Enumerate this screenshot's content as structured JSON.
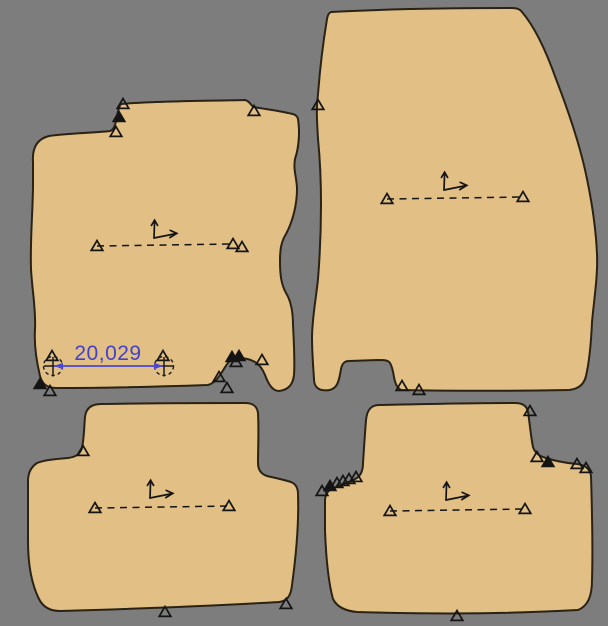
{
  "app": {
    "name": "cad-pattern-canvas",
    "background_color": "#7d7d7d",
    "canvas_width": 608,
    "canvas_height": 626
  },
  "style": {
    "mat_fill": "#e1bf85",
    "outline_color": "#2a2214",
    "marker_color": "#141414",
    "annotation_color": "#1c1c1c",
    "accent_blue": "#4b48d4",
    "dim_text_color": "#4340cc"
  },
  "dimension": {
    "label": "20,029",
    "value": 20029,
    "p1": {
      "x": 53,
      "y": 366
    },
    "p2": {
      "x": 164,
      "y": 366
    },
    "label_pos": {
      "x": 108,
      "y": 360
    },
    "font_size": 21,
    "circle_radius": 9.5
  },
  "mats": [
    {
      "name": "front-mat-left",
      "path": "M 33 162 C 32 148 37 139 49 136 C 70 133 94 133 110 131 C 114 130 116 123 117 116 C 118 111 119 106 121 104 C 155 101 205 101 245 100 C 250 101 250 105 254 107 C 263 109 276 110 288 113 C 294 114 297 115 298 119 C 300 132 299 147 295 159 C 293 170 297 179 297 189 C 297 204 293 221 286 234 C 281 242 280 250 280 261 C 280 274 281 284 286 293 C 291 301 293 312 293 325 C 294 344 295 361 294 375 C 293 385 288 390 279 391 C 272 391 268 383 265 375 C 263 370 260 365 255 362 C 250 359 245 358 239 358 L 235 358 C 229 359 226 366 222 372 C 218 378 215 383 208 385 C 150 387 95 388 57 388 C 47 388 42 384 40 376 C 36 359 34 344 35 329 C 36 309 32 289 31 269 C 30 239 33 209 33 184 Z",
      "axis": {
        "x": 154,
        "y": 238
      },
      "baseline": {
        "x1": 97,
        "y1": 246,
        "x2": 233,
        "y2": 244
      },
      "markers": [
        {
          "x": 123,
          "y": 104,
          "filled": false
        },
        {
          "x": 119,
          "y": 117,
          "filled": true
        },
        {
          "x": 116,
          "y": 132,
          "filled": false
        },
        {
          "x": 254,
          "y": 111,
          "filled": false
        },
        {
          "x": 242,
          "y": 247,
          "filled": false
        },
        {
          "x": 52,
          "y": 356,
          "filled": false
        },
        {
          "x": 163,
          "y": 356,
          "filled": false
        },
        {
          "x": 40,
          "y": 384,
          "filled": true
        },
        {
          "x": 50,
          "y": 391,
          "filled": false
        },
        {
          "x": 232,
          "y": 357,
          "filled": true
        },
        {
          "x": 239,
          "y": 356,
          "filled": true
        },
        {
          "x": 236,
          "y": 362,
          "filled": false
        },
        {
          "x": 262,
          "y": 360,
          "filled": false
        },
        {
          "x": 219,
          "y": 377,
          "filled": false
        },
        {
          "x": 227,
          "y": 388,
          "filled": false
        }
      ]
    },
    {
      "name": "front-mat-right",
      "path": "M 331 12 C 385 9 455 8 512 8 C 517 8 520 9 522 12 C 534 26 545 48 556 79 C 568 110 580 144 587 179 C 592 203 596 231 597 254 C 598 275 594 300 592 322 C 591 345 589 363 586 376 C 584 385 578 389 569 390 C 512 391 452 391 401 390 C 397 388 395 383 394 377 C 393 371 392 366 390 363 C 388 360 384 360 378 360 L 349 361 C 344 361 342 364 341 369 C 340 375 339 382 336 386 C 333 390 328 391 322 390 C 317 389 314 385 314 379 C 313 365 312 351 312 338 C 312 319 316 299 318 279 C 320 254 321 229 321 204 C 321 179 320 159 318 139 C 317 121 316 109 318 94 C 320 68 323 43 327 19 C 328 14 329 13 331 12 Z",
      "axis": {
        "x": 444,
        "y": 190
      },
      "baseline": {
        "x1": 387,
        "y1": 199,
        "x2": 523,
        "y2": 197
      },
      "markers": [
        {
          "x": 318,
          "y": 105,
          "filled": false
        },
        {
          "x": 402,
          "y": 386,
          "filled": false
        },
        {
          "x": 419,
          "y": 390,
          "filled": false
        }
      ]
    },
    {
      "name": "rear-mat-left",
      "path": "M 101 404 C 150 403 200 403 245 403 C 253 403 257 406 258 413 C 259 430 258 448 258 463 C 258 470 261 474 267 476 C 276 478 285 480 291 482 C 296 484 298 488 298 494 C 299 522 296 556 292 585 C 291 596 287 601 279 602 C 210 606 130 609 60 611 C 50 611 43 607 39 599 C 31 583 28 562 28 541 L 28 481 C 28 473 31 467 37 463 C 44 460 56 459 68 458 C 76 457 80 454 82 448 C 84 439 84 428 85 417 C 86 408 92 404 101 404 Z",
      "axis": {
        "x": 150,
        "y": 498
      },
      "baseline": {
        "x1": 95,
        "y1": 508,
        "x2": 229,
        "y2": 506
      },
      "markers": [
        {
          "x": 83,
          "y": 451,
          "filled": false
        },
        {
          "x": 165,
          "y": 612,
          "filled": false
        },
        {
          "x": 286,
          "y": 604,
          "filled": false
        }
      ]
    },
    {
      "name": "rear-mat-right",
      "path": "M 379 405 C 425 404 475 403 515 403 C 523 403 527 406 528 412 C 530 425 531 438 533 447 C 535 453 539 456 546 458 C 555 461 566 463 577 464 C 585 465 590 469 591 476 C 592 508 593 548 592 580 C 592 596 588 606 578 610 C 520 613 455 615 357 612 C 346 611 337 607 333 599 C 328 581 326 556 325 531 L 325 501 C 325 495 327 491 332 489 C 340 485 350 482 357 478 C 361 475 363 470 363 463 C 364 448 365 432 366 420 C 367 410 371 405 379 405 Z",
      "axis": {
        "x": 446,
        "y": 500
      },
      "baseline": {
        "x1": 390,
        "y1": 511,
        "x2": 525,
        "y2": 509
      },
      "markers": [
        {
          "x": 530,
          "y": 411,
          "filled": false
        },
        {
          "x": 537,
          "y": 457,
          "filled": false
        },
        {
          "x": 548,
          "y": 462,
          "filled": true
        },
        {
          "x": 577,
          "y": 464,
          "filled": false
        },
        {
          "x": 586,
          "y": 468,
          "filled": false
        },
        {
          "x": 322,
          "y": 491,
          "filled": false
        },
        {
          "x": 330,
          "y": 486,
          "filled": true
        },
        {
          "x": 337,
          "y": 483,
          "filled": false
        },
        {
          "x": 343,
          "y": 481,
          "filled": false
        },
        {
          "x": 349,
          "y": 479,
          "filled": false
        },
        {
          "x": 356,
          "y": 477,
          "filled": false
        },
        {
          "x": 457,
          "y": 616,
          "filled": false
        }
      ]
    }
  ]
}
